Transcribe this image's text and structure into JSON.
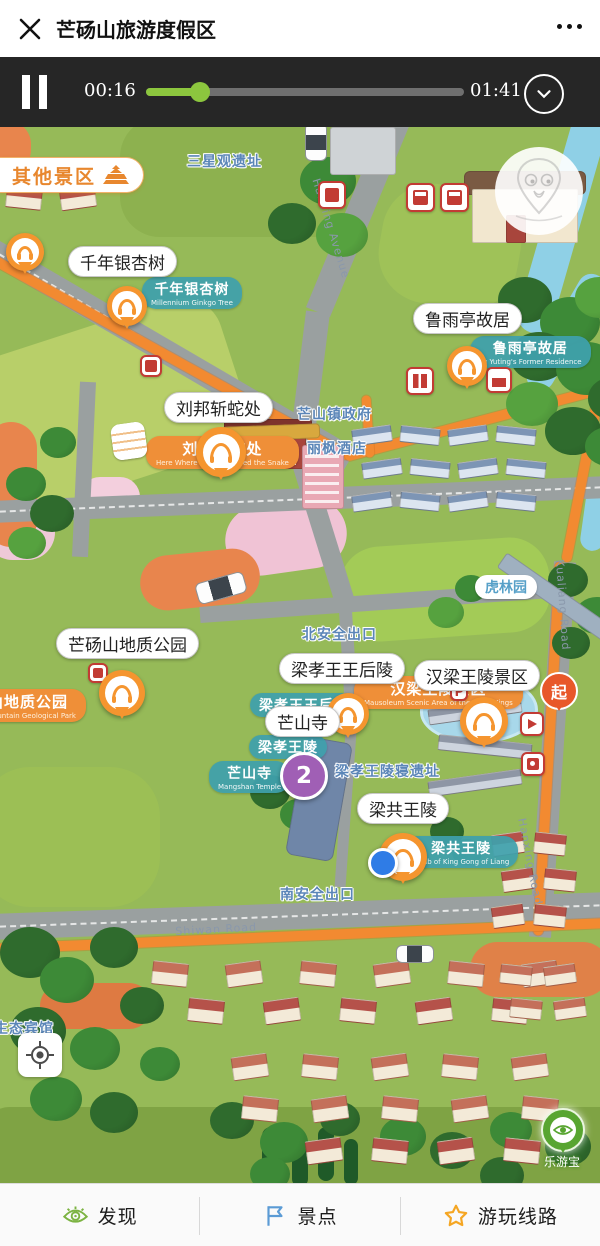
{
  "header": {
    "title": "芒砀山旅游度假区"
  },
  "player": {
    "elapsed": "00:16",
    "total": "01:41",
    "progress_percent": 17
  },
  "map": {
    "other_scenic": "其他景区",
    "callouts": [
      {
        "label": "千年银杏树",
        "x": 68,
        "y": 119
      },
      {
        "label": "鲁雨亭故居",
        "x": 413,
        "y": 176
      },
      {
        "label": "刘邦斩蛇处",
        "x": 164,
        "y": 265
      },
      {
        "label": "芒砀山地质公园",
        "x": 56,
        "y": 501
      },
      {
        "label": "梁孝王王后陵",
        "x": 279,
        "y": 526
      },
      {
        "label": "汉梁王陵景区",
        "x": 414,
        "y": 533
      },
      {
        "label": "芒山寺",
        "x": 265,
        "y": 579
      },
      {
        "label": "梁共王陵",
        "x": 357,
        "y": 666
      }
    ],
    "site_bubbles": [
      {
        "label": "千年银杏树",
        "sub": "Millennium Ginkgo Tree",
        "x": 142,
        "y": 150
      },
      {
        "label": "鲁雨亭故居",
        "sub": "Lu Yuting's Former Residence",
        "x": 470,
        "y": 209
      },
      {
        "label": "梁孝王王后陵",
        "sub": "",
        "x": 250,
        "y": 566
      },
      {
        "label": "梁孝王陵",
        "sub": "",
        "x": 249,
        "y": 608
      },
      {
        "label": "芒山寺",
        "sub": "Mangshan Temple",
        "x": 209,
        "y": 634
      },
      {
        "label": "梁共王陵",
        "sub": "Tomb of King Gong of Liang",
        "x": 404,
        "y": 709
      }
    ],
    "white_bubble": {
      "label": "虎林园",
      "x": 475,
      "y": 448
    },
    "banners": [
      {
        "label": "刘邦斩蛇处",
        "sub": "Here Where Liu Bang Killed the Snake",
        "x": 146,
        "y": 309
      },
      {
        "label": "汉梁王陵景区",
        "sub": "Mausoleum Scenic Area of the Liang Kings",
        "x": 354,
        "y": 549
      },
      {
        "label": "芒砀山地质公园",
        "sub": "Mangdang Mountain Geological Park",
        "x": -62,
        "y": 562
      }
    ],
    "blue_texts": [
      {
        "label": "三星观遗址",
        "x": 187,
        "y": 24
      },
      {
        "label": "芒山镇政府",
        "x": 297,
        "y": 277
      },
      {
        "label": "丽枫酒店",
        "x": 307,
        "y": 311
      },
      {
        "label": "北安全出口",
        "x": 302,
        "y": 497
      },
      {
        "label": "梁孝王陵寝遗址",
        "x": 335,
        "y": 634
      },
      {
        "label": "南安全出口",
        "x": 280,
        "y": 757
      },
      {
        "label": "生态宾馆",
        "x": -6,
        "y": 891
      }
    ],
    "road_labels": [
      {
        "label": "Hanxing Avenue",
        "x": 322,
        "y": 50,
        "rotate": 73
      },
      {
        "label": "Kualiang Road",
        "x": 566,
        "y": 432,
        "rotate": 86
      },
      {
        "label": "Hanxing Road",
        "x": 528,
        "y": 690,
        "rotate": 79
      },
      {
        "label": "Shiwan Road",
        "x": 175,
        "y": 798,
        "rotate": -3
      }
    ],
    "audio_pins": [
      {
        "cx": 25,
        "cy": 125,
        "s": 38
      },
      {
        "cx": 127,
        "cy": 179,
        "s": 40
      },
      {
        "cx": 467,
        "cy": 239,
        "s": 40
      },
      {
        "cx": 221,
        "cy": 325,
        "s": 50
      },
      {
        "cx": 122,
        "cy": 566,
        "s": 46
      },
      {
        "cx": 348,
        "cy": 587,
        "s": 42
      },
      {
        "cx": 484,
        "cy": 594,
        "s": 48
      },
      {
        "cx": 403,
        "cy": 730,
        "s": 48
      }
    ],
    "poi_icons": [
      {
        "type": "shop",
        "x": 318,
        "y": 54,
        "s": 28
      },
      {
        "type": "fuel",
        "x": 406,
        "y": 56,
        "s": 29
      },
      {
        "type": "bus",
        "x": 440,
        "y": 56,
        "s": 29
      },
      {
        "type": "toilet",
        "x": 406,
        "y": 240,
        "s": 28
      },
      {
        "type": "hotel",
        "x": 486,
        "y": 240,
        "s": 26
      },
      {
        "type": "sign",
        "x": 88,
        "y": 536,
        "s": 20
      },
      {
        "type": "sign",
        "x": 140,
        "y": 228,
        "s": 22
      },
      {
        "type": "sign",
        "x": 493,
        "y": 545,
        "s": 15
      },
      {
        "type": "sign",
        "x": 511,
        "y": 545,
        "s": 15
      },
      {
        "type": "parking",
        "label": "P",
        "x": 450,
        "y": 556,
        "s": 18
      },
      {
        "type": "play",
        "x": 520,
        "y": 585,
        "s": 24
      },
      {
        "type": "camera",
        "x": 521,
        "y": 625,
        "s": 24
      }
    ],
    "stop_badge": {
      "number": "2"
    },
    "start_marker": {
      "label": "起"
    },
    "leyoubao": {
      "label": "乐游宝"
    }
  },
  "tabbar": {
    "items": [
      {
        "label": "发现"
      },
      {
        "label": "景点"
      },
      {
        "label": "游玩线路"
      }
    ]
  }
}
